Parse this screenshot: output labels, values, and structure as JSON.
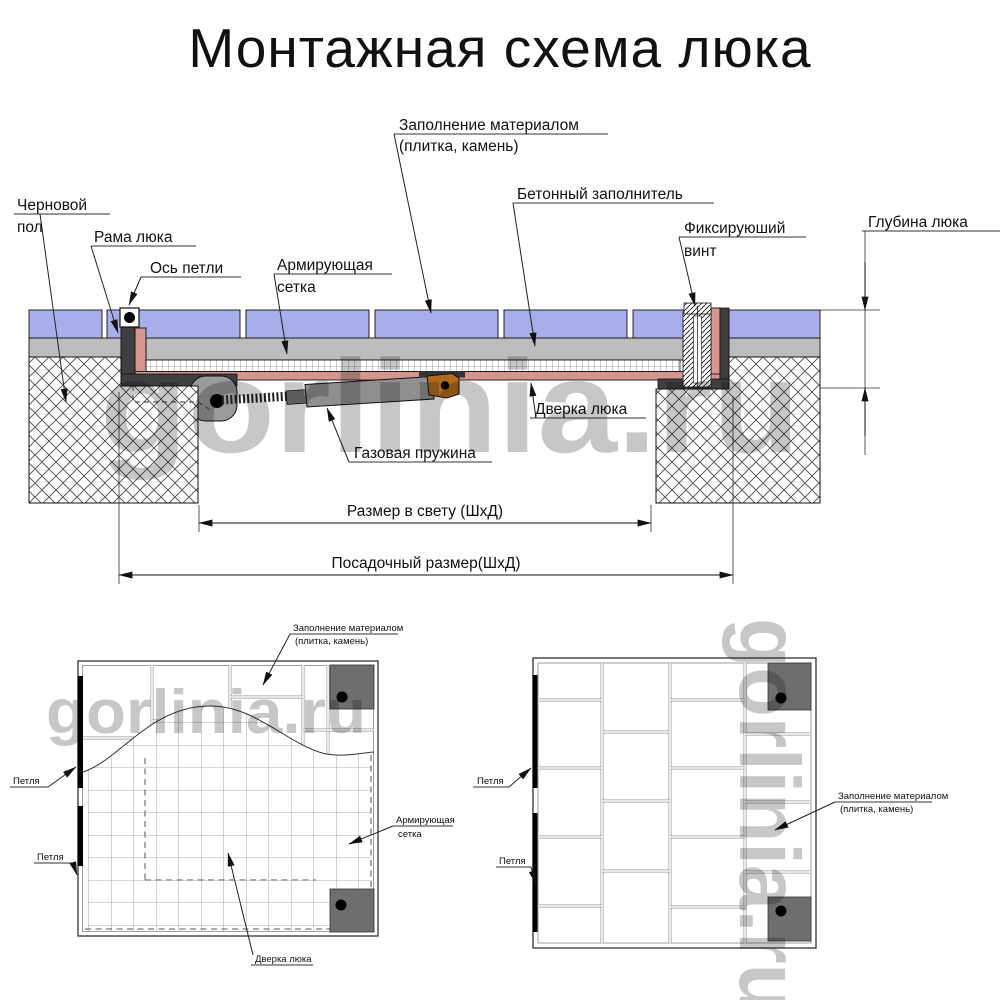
{
  "title": "Монтажная схема люка",
  "watermark": "gorlinia.ru",
  "section": {
    "labels": {
      "rough_floor_1": "Черновой",
      "rough_floor_2": "пол",
      "frame": "Рама люка",
      "hinge_axis": "Ось петли",
      "mesh_1": "Армирующая",
      "mesh_2": "сетка",
      "fill_1": "Заполнение материалом",
      "fill_2": "(плитка, камень)",
      "concrete": "Бетонный заполнитель",
      "screw_1": "Фиксируюший",
      "screw_2": "винт",
      "depth": "Глубина люка",
      "door": "Дверка люка",
      "gas_spring": "Газовая пружина",
      "clear_size": "Размер в свету (ШхД)",
      "seat_size": "Посадочный размер(ШхД)"
    }
  },
  "plan_left": {
    "labels": {
      "fill_1": "Заполнение материалом",
      "fill_2": "(плитка, камень)",
      "hinge_top": "Петля",
      "hinge_bottom": "Петля",
      "mesh_1": "Армирующая",
      "mesh_2": "сетка",
      "door": "Дверка люка"
    }
  },
  "plan_right": {
    "labels": {
      "hinge_top": "Петля",
      "hinge_bottom": "Петля",
      "fill_1": "Заполнение материалом",
      "fill_2": "(плитка, камень)"
    }
  },
  "colors": {
    "tile": "#a9aeea",
    "screed": "#bdbdbd",
    "frame": "#3f3f3f",
    "door_pan": "#d6968e",
    "spring": "#8f8f8f",
    "bracket": "#b06a1c",
    "corner": "#6e6e6e",
    "watermark": "#c7c7c7"
  }
}
